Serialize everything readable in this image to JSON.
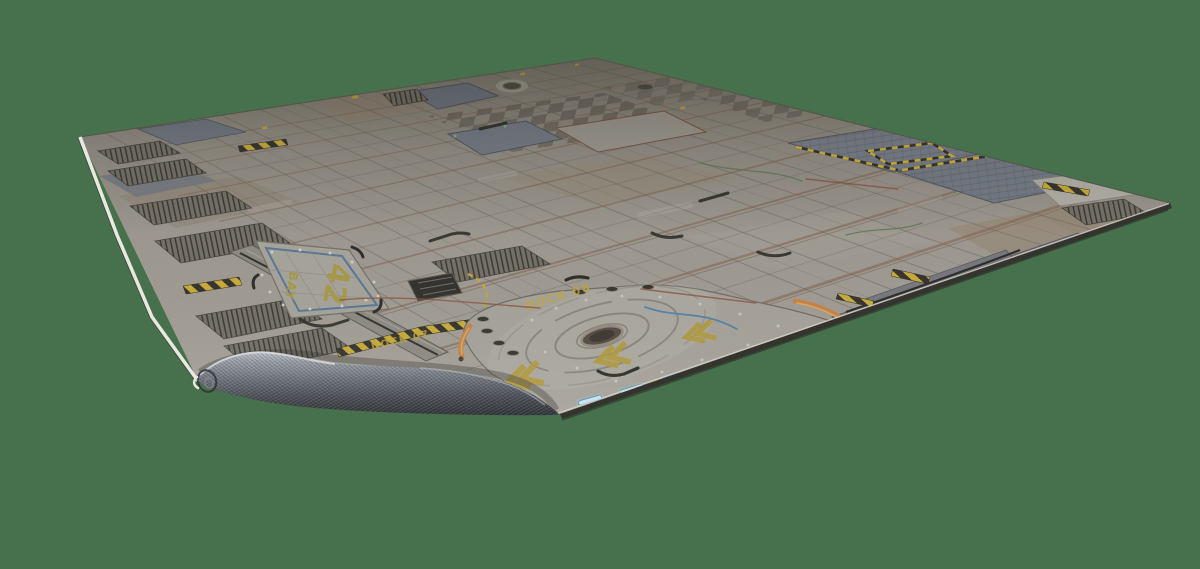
{
  "scene": {
    "type": "3d-product-render",
    "description": "Perspective render of a sci-fi industrial space-station battle mat (neoprene gaming mat) on a plain green background, front-left corner curled up showing the dark woven rubber backing",
    "background_color": "#47704d"
  },
  "mat": {
    "theme": "sci-fi industrial deck floor with panels, grates, hazard stripes and landing pads",
    "labels": {
      "bay_word": "BAY",
      "bay_number": "42",
      "dock_front": "DOCK 08",
      "dock_left": "DOCK 07"
    },
    "colors": {
      "surface_base": "#9d9890",
      "surface_far": "#7f7a6f",
      "panel_tan": "#93856f",
      "panel_blue_grey": "#727a86",
      "seam_rust": "#7c5a44",
      "hazard_yellow": "#cfae2b",
      "hazard_black": "#27251f",
      "marking_yellow": "#c2a52e",
      "edge_light": "#e9e8e0",
      "edge_dark": "#34332d",
      "dock_light_blue": "#cfeeff",
      "pipe_orange": "#cd8038",
      "backing_grey": "#72777e"
    }
  }
}
